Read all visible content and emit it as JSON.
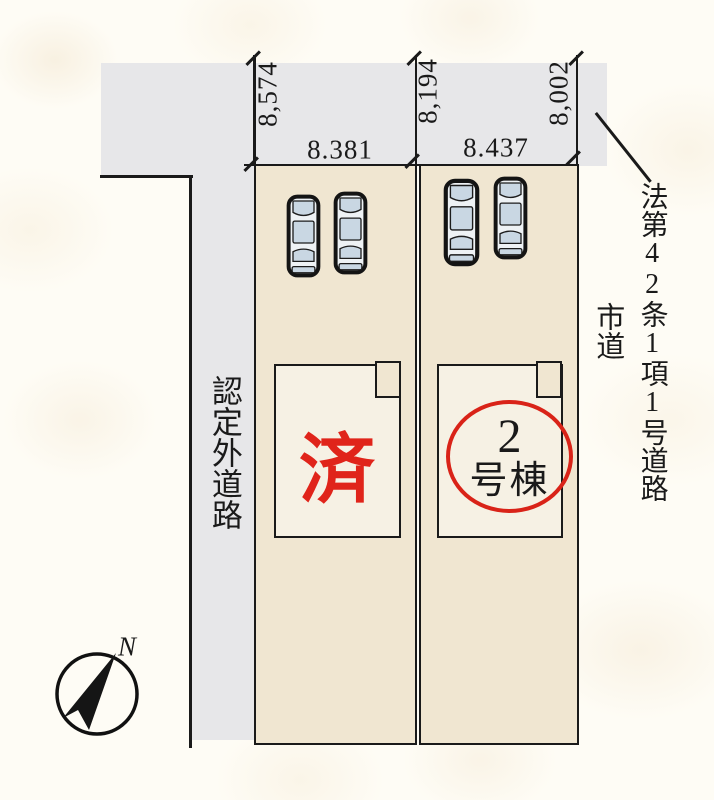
{
  "plan": {
    "dim_left_depth": "8,574",
    "dim_mid_depth": "8,194",
    "dim_right_depth": "8,002",
    "lot1_width": "8.381",
    "lot2_width": "8.437",
    "road_left_label": "認定外道路",
    "road_right_label": "法第42条1項1号道路",
    "road_right_sublabel": "市道",
    "lot1_status": "済",
    "lot2_number": "2",
    "lot2_suffix": "号棟",
    "compass_north": "N"
  },
  "colors": {
    "lot_fill": "#f0e6d1",
    "building_fill": "#f6f1e4",
    "road_fill": "#e7e7e9",
    "line": "#1a1a1a",
    "accent_red": "#dd2418",
    "car_glass": "#c9d7e3"
  },
  "icons": [
    "compass-icon",
    "car-icon"
  ]
}
